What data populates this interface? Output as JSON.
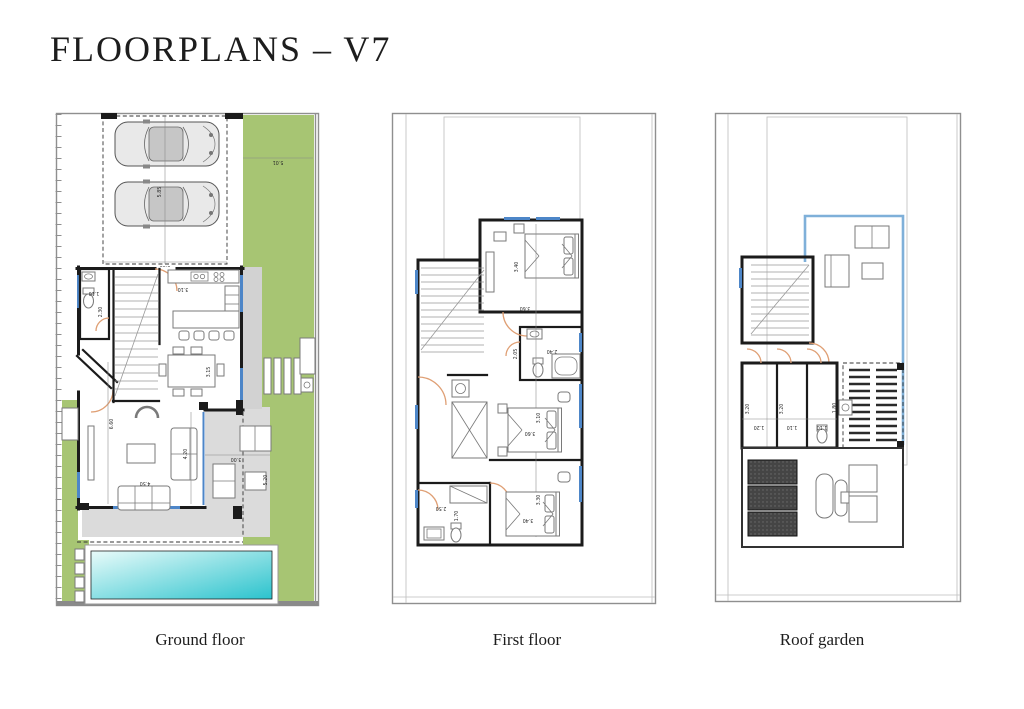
{
  "page": {
    "title": "FLOORPLANS – V7",
    "background": "#ffffff"
  },
  "plans": [
    {
      "id": "ground-floor",
      "label": "Ground floor",
      "dims": [
        "5.85",
        "5.60",
        "5.01",
        "1.10",
        "2.30",
        "3.10",
        "3.15",
        "6.60",
        "4.20",
        "4.50",
        "3.00",
        "5.20"
      ]
    },
    {
      "id": "first-floor",
      "label": "First floor",
      "dims": [
        "3.40",
        "3.60",
        "2.05",
        "2.40",
        "3.10",
        "3.60",
        "2.50",
        "1.70",
        "3.30",
        "3.40"
      ]
    },
    {
      "id": "roof-garden",
      "label": "Roof garden",
      "dims": [
        "3.20",
        "3.20",
        "1.20",
        "1.10",
        "1.10",
        "1.80"
      ]
    }
  ],
  "colors": {
    "wall": "#1b1b1b",
    "line": "#8f8f8f",
    "garden": "#a7c573",
    "terrace": "#dbdbdb",
    "walkway": "#d2d2d2",
    "pool_light": "#e9fbfa",
    "pool_dark": "#2bc3cd",
    "window": "#4d86c8",
    "door": "#df9f74",
    "furn": "#7a7a7a",
    "carbody": "#e9e9e9",
    "carroof": "#c6c6c6",
    "solar": "#454545",
    "blue_border": "#7fb0d9"
  }
}
